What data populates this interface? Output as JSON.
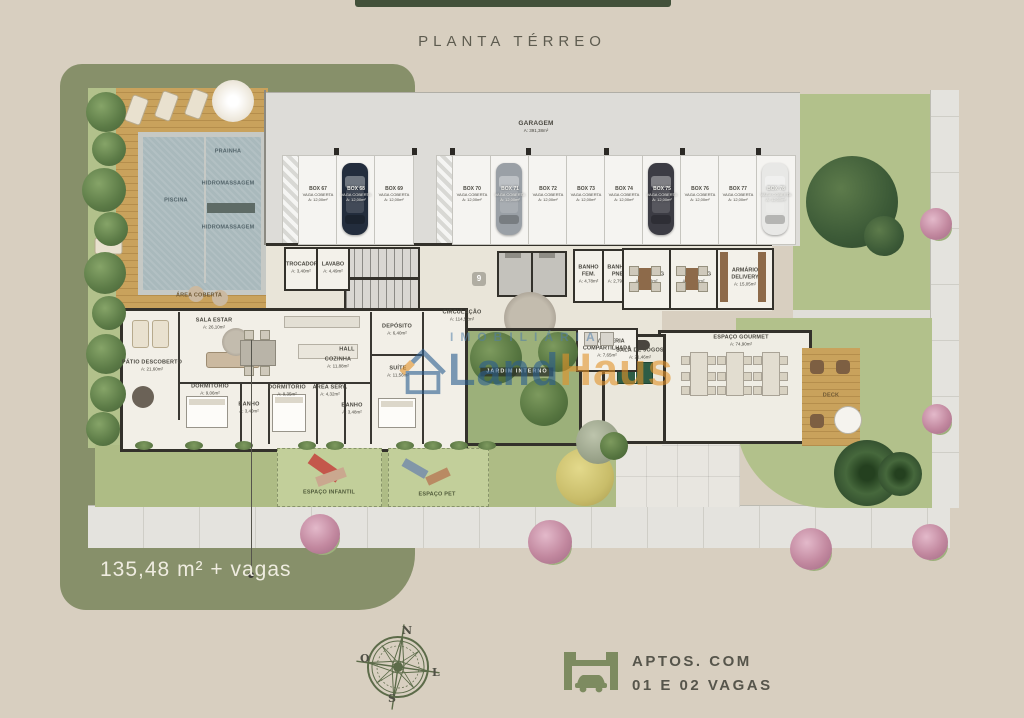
{
  "page": {
    "title": "PLANTA TÉRREO",
    "measure": "135,48 m² + vagas"
  },
  "watermark": {
    "word": "IMOBILIÁRIA",
    "brand_1": "Land",
    "brand_2": "Haus"
  },
  "compass": {
    "n": "N",
    "s": "S",
    "o": "O",
    "l": "L"
  },
  "footer": {
    "line1": "APTOS. COM",
    "line2": "01 E 02 VAGAS"
  },
  "elevator_badge": "9",
  "garage": {
    "stall_sub": "VAGA COBERTA",
    "stall_area": "A: 12,00m²",
    "stalls": [
      {
        "box": "BOX 67"
      },
      {
        "box": "BOX 68",
        "car": "#232d3d"
      },
      {
        "box": "BOX 69"
      },
      {
        "box": "BOX 70"
      },
      {
        "box": "BOX 71",
        "car": "#9aa0a6"
      },
      {
        "box": "BOX 72"
      },
      {
        "box": "BOX 73"
      },
      {
        "box": "BOX 74"
      },
      {
        "box": "BOX 75",
        "car": "#3c3c44"
      },
      {
        "box": "BOX 76"
      },
      {
        "box": "BOX 77"
      },
      {
        "box": "BOX 78",
        "car": "#e8e8e6"
      }
    ]
  },
  "rooms": {
    "garagem": {
      "name": "GARAGEM",
      "area": "A: 391,38m²"
    },
    "trocador": {
      "name": "TROCADOR",
      "area": "A: 3,40m²"
    },
    "lavabo": {
      "name": "LAVABO",
      "area": "A: 4,49m²"
    },
    "banho_fem": {
      "name": "BANHO FEM.",
      "area": "A: 4,78m²"
    },
    "banho_pne": {
      "name": "BANHO PNE",
      "area": "A: 2,79m²"
    },
    "coworking_1": {
      "name": "COWORKING",
      "area": "A: 16,03m²"
    },
    "coworking_2": {
      "name": "COWORKING",
      "area": "A: 16,03m²"
    },
    "armario_delivery": {
      "name": "ARMÁRIO DELIVERY",
      "area": "A: 15,05m²"
    },
    "circulacao": {
      "name": "CIRCULAÇÃO",
      "area": "A: 114,52m²"
    },
    "lavanderia": {
      "name": "LAVANDERIA COMPARTILHADA",
      "area": "A: 7,65m²"
    },
    "sala_jogos": {
      "name": "SALA DE JOGOS",
      "area": "A: 21,46m²"
    },
    "espaco_gourmet": {
      "name": "ESPAÇO GOURMET",
      "area": "A: 74,90m²"
    },
    "deck": {
      "name": "DECK"
    },
    "jardim_interno": {
      "name": "JARDIM INTERNO"
    },
    "patio": {
      "name": "PÁTIO DESCOBERTO",
      "area": "A: 21,60m²"
    },
    "sala_estar": {
      "name": "SALA ESTAR",
      "area": "A: 26,10m²"
    },
    "cozinha": {
      "name": "COZINHA",
      "area": "A: 11,88m²"
    },
    "hall": {
      "name": "HALL"
    },
    "deposito": {
      "name": "DEPÓSITO",
      "area": "A: 6,40m²"
    },
    "suite": {
      "name": "SUÍTE",
      "area": "A: 11,56m²"
    },
    "dormitorio_1": {
      "name": "DORMITÓRIO",
      "area": "A: 9,06m²"
    },
    "banho_1": {
      "name": "BANHO",
      "area": "A: 3,40m²"
    },
    "dormitorio_2": {
      "name": "DORMITÓRIO",
      "area": "A: 9,35m²"
    },
    "area_serv": {
      "name": "ÁREA SERV.",
      "area": "A: 4,32m²"
    },
    "banho_2": {
      "name": "BANHO",
      "area": "A: 3,48m²"
    },
    "area_coberta": {
      "name": "ÁREA COBERTA"
    },
    "piscina": {
      "name": "PISCINA"
    },
    "prainha": {
      "name": "PRAINHA"
    },
    "hidro_1": {
      "name": "HIDROMASSAGEM"
    },
    "hidro_2": {
      "name": "HIDROMASSAGEM"
    },
    "espaco_infantil": {
      "name": "ESPAÇO INFANTIL"
    },
    "espaco_pet": {
      "name": "ESPAÇO PET"
    }
  },
  "colors": {
    "accent_green": "#87906a",
    "dark_bar": "#42513a",
    "brand_blue": "#2a5d8f",
    "brand_orange": "#e2932a"
  }
}
